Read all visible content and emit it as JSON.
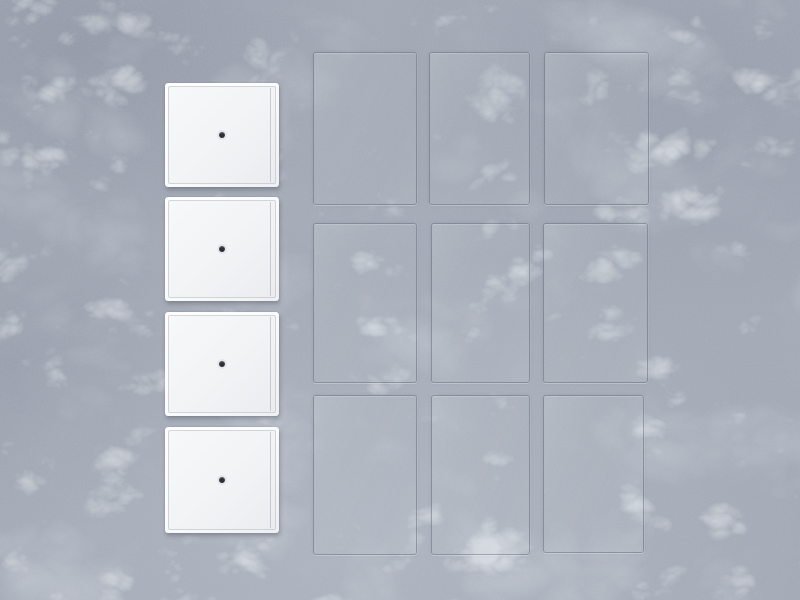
{
  "window": {
    "width": 800,
    "height": 600
  },
  "scene": {
    "type": "product-photo",
    "description": "Four white square figure display bases with center peg holes arranged in a vertical column, beside a 3x3 grid of nine clear acrylic backdrop sheets, all laid flat on a gray marble surface",
    "surface": {
      "material": "gray-marble",
      "base_color": "#a4aab6",
      "vein_color": "#e3e6ec",
      "mottle_color": "#6d7485"
    },
    "bases": {
      "count": 4,
      "shape": "square",
      "face_color": "#f1f3f5",
      "rim_color": "#fbfcfd",
      "groove_color": "#b6bac1",
      "hole_color": "#2d2f33",
      "items": [
        {
          "id": "base-1",
          "x": 165,
          "y": 83,
          "w": 114,
          "h": 104
        },
        {
          "id": "base-2",
          "x": 165,
          "y": 197,
          "w": 114,
          "h": 104
        },
        {
          "id": "base-3",
          "x": 165,
          "y": 312,
          "w": 114,
          "h": 104
        },
        {
          "id": "base-4",
          "x": 165,
          "y": 427,
          "w": 114,
          "h": 106
        }
      ]
    },
    "sheets": {
      "count": 9,
      "rows": 3,
      "cols": 3,
      "material": "clear-acrylic",
      "edge_color": "rgba(84,94,110,0.45)",
      "tint_color": "rgba(210,220,232,0.07)",
      "items": [
        {
          "id": "sheet-r1c1",
          "x": 313,
          "y": 52,
          "w": 104,
          "h": 153
        },
        {
          "id": "sheet-r1c2",
          "x": 429,
          "y": 52,
          "w": 101,
          "h": 153
        },
        {
          "id": "sheet-r1c3",
          "x": 544,
          "y": 52,
          "w": 105,
          "h": 153
        },
        {
          "id": "sheet-r2c1",
          "x": 313,
          "y": 223,
          "w": 104,
          "h": 160
        },
        {
          "id": "sheet-r2c2",
          "x": 431,
          "y": 223,
          "w": 99,
          "h": 160
        },
        {
          "id": "sheet-r2c3",
          "x": 543,
          "y": 223,
          "w": 105,
          "h": 160
        },
        {
          "id": "sheet-r3c1",
          "x": 313,
          "y": 395,
          "w": 104,
          "h": 160
        },
        {
          "id": "sheet-r3c2",
          "x": 431,
          "y": 395,
          "w": 99,
          "h": 160
        },
        {
          "id": "sheet-r3c3",
          "x": 543,
          "y": 395,
          "w": 101,
          "h": 158
        }
      ]
    }
  }
}
